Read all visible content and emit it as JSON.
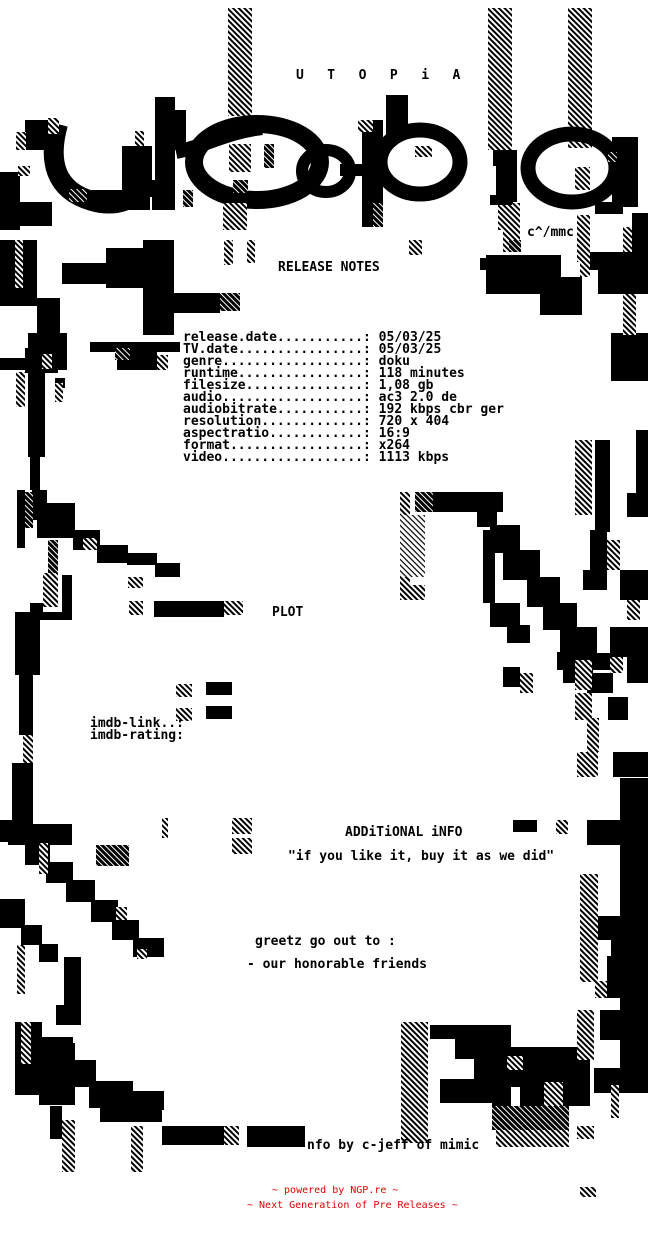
{
  "page": {
    "background": "#ffffff",
    "ink": "#000000",
    "accent_red": "#e00000"
  },
  "header": {
    "group_name_spaced": "U   T   O   P   i   A",
    "ascii_logo_word": "utopia",
    "art_credit": "c^/mmc"
  },
  "release_notes": {
    "title": "RELEASE NOTES",
    "fields": [
      {
        "label": "release.date...........",
        "value": "05/03/25"
      },
      {
        "label": "TV.date................",
        "value": "05/03/25"
      },
      {
        "label": "genre..................",
        "value": "doku"
      },
      {
        "label": "runtime................",
        "value": "118 minutes"
      },
      {
        "label": "filesize...............",
        "value": "1,08 gb"
      },
      {
        "label": "audio..................",
        "value": "ac3 2.0 de"
      },
      {
        "label": "audiobitrate...........",
        "value": "192 kbps cbr ger"
      },
      {
        "label": "resolution.............",
        "value": "720 x 404"
      },
      {
        "label": "aspectratio............",
        "value": "16:9"
      },
      {
        "label": "format.................",
        "value": "x264"
      },
      {
        "label": "video..................",
        "value": "1113 kbps"
      }
    ]
  },
  "plot": {
    "title": "PLOT",
    "imdb_link_label": "imdb-link..:",
    "imdb_rating_label": "imdb-rating:"
  },
  "additional_info": {
    "title": "ADDiTiONAL iNFO",
    "quote": "\"if you like it, buy it as we did\"",
    "greetz_heading": "greetz go out to :",
    "greetz_line": "- our honorable friends"
  },
  "footer": {
    "nfo_credit": "nfo by c-jeff of mimic",
    "powered_by": "~ powered by NGP.re ~",
    "tagline": "~ Next Generation of Pre Releases ~"
  }
}
